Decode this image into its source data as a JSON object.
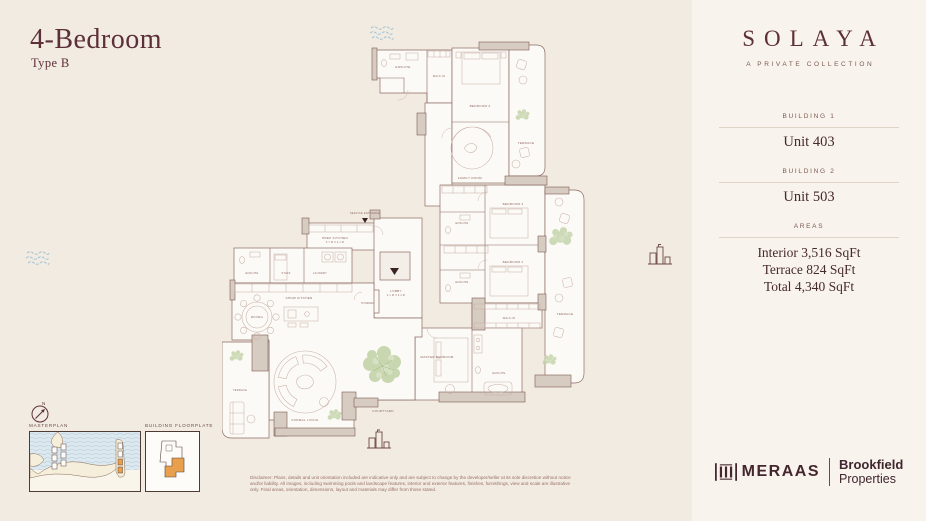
{
  "page": {
    "title": "4-Bedroom",
    "subtitle": "Type B"
  },
  "sidebar": {
    "brand": "SOLAYA",
    "tagline": "A PRIVATE COLLECTION",
    "sections": [
      {
        "label": "BUILDING 1",
        "value": "Unit 403"
      },
      {
        "label": "BUILDING 2",
        "value": "Unit 503"
      }
    ],
    "areas": {
      "label": "AREAS",
      "lines": [
        "Interior 3,516 SqFt",
        "Terrace 824 SqFt",
        "Total 4,340 SqFt"
      ]
    },
    "logos": {
      "meraas": "MERAAS",
      "brookfield_line1": "Brookfield",
      "brookfield_line2": "Properties"
    }
  },
  "minimaps": {
    "masterplan_label": "MASTERPLAN",
    "floorplate_label": "BUILDING FLOORPLATE",
    "compass_n": "N"
  },
  "plan": {
    "rooms": [
      {
        "label": "ENSUITE"
      },
      {
        "label": "WALK-IN"
      },
      {
        "label": "BEDROOM 4"
      },
      {
        "label": "TERRACE"
      },
      {
        "label": "FAMILY ROOM"
      },
      {
        "label": "SERVICE ENTRANCE"
      },
      {
        "label": "PREP KITCHEN",
        "dims": "3.7 M X 3.1 M"
      },
      {
        "label": "ENSUITE"
      },
      {
        "label": "STAFF"
      },
      {
        "label": "LAUNDRY"
      },
      {
        "label": "SHOW KITCHEN"
      },
      {
        "label": "DINING"
      },
      {
        "label": "LOBBY",
        "dims": "4.1 M X 3.4 M"
      },
      {
        "label": "POWDER"
      },
      {
        "label": "BEDROOM 3"
      },
      {
        "label": "ENSUITE"
      },
      {
        "label": "BEDROOM 2"
      },
      {
        "label": "ENSUITE"
      },
      {
        "label": "TERRACE"
      },
      {
        "label": "WALK-IN"
      },
      {
        "label": "MASTER BEDROOM"
      },
      {
        "label": "ENSUITE"
      },
      {
        "label": "COURTYARD"
      },
      {
        "label": "FORMAL LIVING"
      },
      {
        "label": "TERRACE"
      }
    ]
  },
  "disclaimer": {
    "lines": [
      "Disclaimer: Plans, details and unit orientation included are indicative only and are subject to change by the developer/seller at its sole discretion without notice",
      "and/or liability. All images, including swimming pools and landscape features, interior and exterior features, finishes, furnishings, view and scale are illustrative",
      "only. Final areas, orientation, dimensions, layout and materials may differ from those stated."
    ]
  },
  "colors": {
    "accent_maroon": "#5d2f38",
    "wall_taupe": "#d6ccc1",
    "water_blue": "#d9e7ee",
    "highlight_orange": "#e8a04c",
    "greenery": "#c2d3a8"
  }
}
